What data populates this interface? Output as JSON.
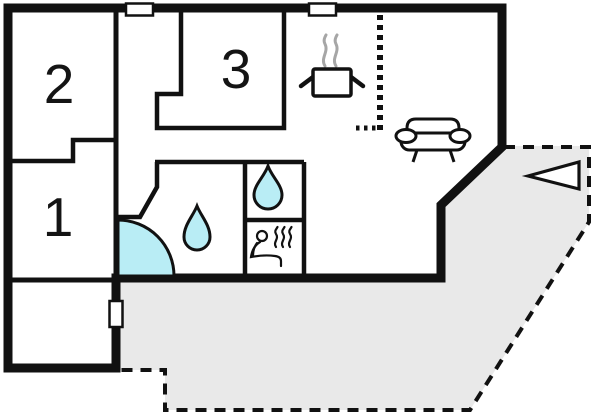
{
  "page": {
    "title": "Floor plan"
  },
  "rooms": {
    "room1": {
      "label": "1"
    },
    "room2": {
      "label": "2"
    },
    "room3": {
      "label": "3"
    }
  },
  "colors": {
    "wall": "#111111",
    "water": "#b9edf5",
    "terrace_fill": "#e9e9e9",
    "steam": "#a6a6a6",
    "background": "#ffffff"
  },
  "icons": {
    "door_swing": "quarter-circle-door-swing",
    "water_drop": "teardrop-water-symbol",
    "sauna": "sauna-person-with-heat-waves",
    "stove": "cooking-pot-with-steam",
    "kitchen_divider": "dashed-l-shaped-boundary",
    "sofa": "sofa-front-view",
    "entrance_arrow": "left-pointing-triangle",
    "window": "white-rectangle-window-marker",
    "terrace": "gray-dashed-terrace-area"
  }
}
